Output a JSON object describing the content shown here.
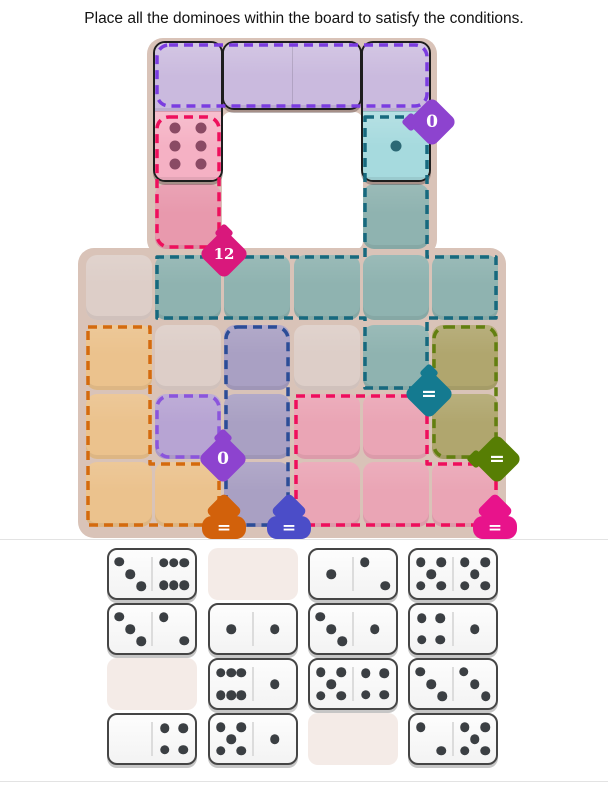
{
  "title": "Place all the dominoes within the board to satisfy the conditions.",
  "board": {
    "frame_color": "#d9c3b8",
    "hole_color": "#ffffff",
    "plain_cell_color": "#ddcec8",
    "plain_cells": [
      {
        "row": 4,
        "col": 1
      },
      {
        "row": 5,
        "col": 2
      },
      {
        "row": 5,
        "col": 4
      }
    ],
    "regions": [
      {
        "id": "purple-top",
        "fill": "#c2b0da",
        "border": "#7b3ce0",
        "cells": [
          [
            1,
            2
          ],
          [
            1,
            3
          ],
          [
            1,
            4
          ],
          [
            1,
            5
          ]
        ],
        "badge": {
          "label": "0",
          "color": "#8d43cf"
        }
      },
      {
        "id": "pink-top",
        "fill": "#e899ad",
        "border": "#ee0f5c",
        "cells": [
          [
            2,
            2
          ],
          [
            3,
            2
          ]
        ],
        "badge": {
          "label": "12",
          "color": "#d9187c"
        }
      },
      {
        "id": "teal",
        "fill": "#8fb3b0",
        "border": "#17697e",
        "cells": [
          [
            2,
            5
          ],
          [
            3,
            5
          ],
          [
            4,
            2
          ],
          [
            4,
            3
          ],
          [
            4,
            4
          ],
          [
            4,
            5
          ],
          [
            4,
            6
          ],
          [
            5,
            5
          ]
        ],
        "badge": {
          "label": "=",
          "color": "#147a90"
        }
      },
      {
        "id": "orange",
        "fill": "#ebc28d",
        "border": "#d46a0e",
        "cells": [
          [
            5,
            1
          ],
          [
            6,
            1
          ],
          [
            7,
            1
          ],
          [
            7,
            2
          ]
        ],
        "badge": {
          "label": "=",
          "color": "#d2610b"
        }
      },
      {
        "id": "purple-small",
        "fill": "#b7a4d3",
        "border": "#8b55dc",
        "cells": [
          [
            6,
            2
          ]
        ],
        "badge": {
          "label": "0",
          "color": "#8d43cf"
        }
      },
      {
        "id": "navy",
        "fill": "#a9a0c3",
        "border": "#2c4d97",
        "cells": [
          [
            5,
            3
          ],
          [
            6,
            3
          ],
          [
            7,
            3
          ]
        ],
        "badge": {
          "label": "=",
          "color": "#4b4dc8"
        }
      },
      {
        "id": "pink-big",
        "fill": "#eaa5b5",
        "border": "#ee0f5c",
        "cells": [
          [
            6,
            4
          ],
          [
            6,
            5
          ],
          [
            7,
            4
          ],
          [
            7,
            5
          ],
          [
            7,
            6
          ]
        ],
        "badge": {
          "label": "=",
          "color": "#e8138b"
        }
      },
      {
        "id": "olive",
        "fill": "#b0a66e",
        "border": "#627f10",
        "cells": [
          [
            5,
            6
          ],
          [
            6,
            6
          ]
        ],
        "badge": {
          "label": "=",
          "color": "#577e04"
        }
      }
    ],
    "placed_dominoes": [
      {
        "values": [
          0,
          6
        ],
        "dir": "v",
        "row": 1,
        "col": 2,
        "half_fills": [
          "#cabade",
          "#f5b1c4"
        ],
        "pip_color": "#8a4a64"
      },
      {
        "values": [
          0,
          0
        ],
        "dir": "h",
        "row": 1,
        "col": 3,
        "half_fills": [
          "#cabade",
          "#cabade"
        ],
        "pip_color": "#777777"
      },
      {
        "values": [
          0,
          1
        ],
        "dir": "v",
        "row": 1,
        "col": 5,
        "half_fills": [
          "#cabade",
          "#a6dade"
        ],
        "pip_color": "#2c6875"
      }
    ]
  },
  "tray": {
    "slot_color": "#f4ebe7",
    "domino_pip_color": "#3b3f43",
    "rows": [
      [
        {
          "values": [
            3,
            6
          ]
        },
        null,
        {
          "values": [
            1,
            2
          ]
        },
        {
          "values": [
            5,
            5
          ]
        }
      ],
      [
        {
          "values": [
            3,
            2
          ]
        },
        {
          "values": [
            1,
            1
          ]
        },
        {
          "values": [
            3,
            1
          ]
        },
        {
          "values": [
            4,
            1
          ]
        }
      ],
      [
        null,
        {
          "values": [
            6,
            1
          ]
        },
        {
          "values": [
            5,
            4
          ]
        },
        {
          "values": [
            3,
            3
          ]
        }
      ],
      [
        {
          "values": [
            0,
            4
          ]
        },
        {
          "values": [
            5,
            1
          ]
        },
        null,
        {
          "values": [
            2,
            5
          ]
        }
      ]
    ]
  }
}
